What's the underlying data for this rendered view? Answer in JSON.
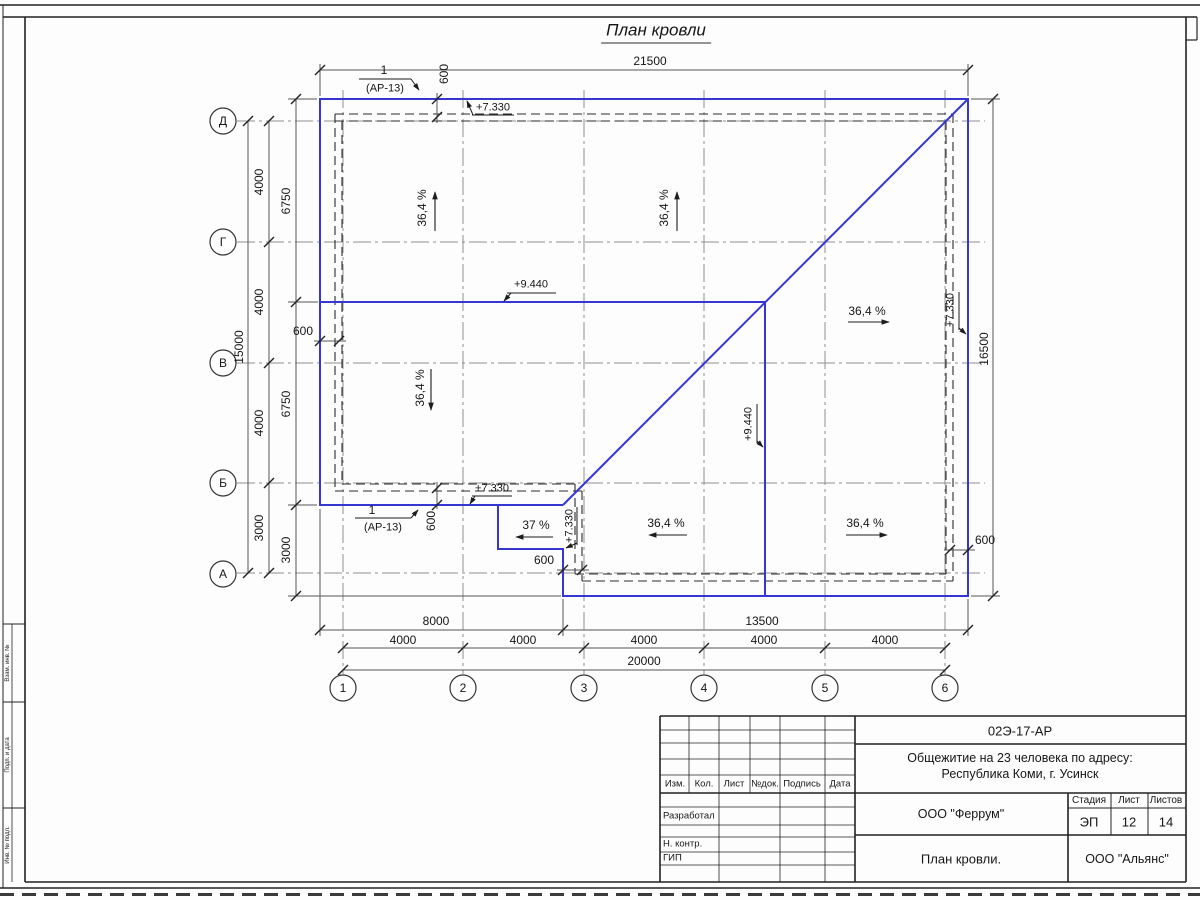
{
  "sheet": {
    "title": "План кровли"
  },
  "axes": {
    "rows": [
      "Д",
      "Г",
      "В",
      "Б",
      "А"
    ],
    "cols": [
      "1",
      "2",
      "3",
      "4",
      "5",
      "6"
    ]
  },
  "dims": {
    "top_total": "21500",
    "right_total": "16500",
    "left_total": "15000",
    "left_chain": [
      "4000",
      "4000",
      "4000",
      "3000"
    ],
    "left_inner": [
      "6750",
      "6750",
      "3000"
    ],
    "bottom_left": "8000",
    "bottom_right": "13500",
    "bottom_chain": [
      "4000",
      "4000",
      "4000",
      "4000",
      "4000"
    ],
    "bottom_total": "20000",
    "offset": "600"
  },
  "marks": {
    "eave": "+7.330",
    "ridge": "+9.440"
  },
  "slopes": {
    "main": "36,4 %",
    "porch": "37 %"
  },
  "callout": {
    "num": "1",
    "ref": "(АР-13)"
  },
  "stamp": {
    "doc_number": "02Э-17-АР",
    "project_line1": "Общежитие на 23 человека по адресу:",
    "project_line2": "Республика Коми, г. Усинск",
    "designer": "ООО \"Феррум\"",
    "stage_label": "Стадия",
    "sheet_label": "Лист",
    "sheets_label": "Листов",
    "stage": "ЭП",
    "sheet_no": "12",
    "sheets_total": "14",
    "drawing_name": "План кровли.",
    "contractor": "ООО \"Альянс\"",
    "cols": [
      "Изм.",
      "Кол.",
      "Лист",
      "№док.",
      "Подпись",
      "Дата"
    ],
    "row_developed": "Разработал",
    "row_ncontrol": "Н. контр.",
    "row_gip": "ГИП"
  },
  "side_column": {
    "labels": [
      "Взам. инв. №",
      "Подп. и дата",
      "Инв. № подл."
    ]
  }
}
